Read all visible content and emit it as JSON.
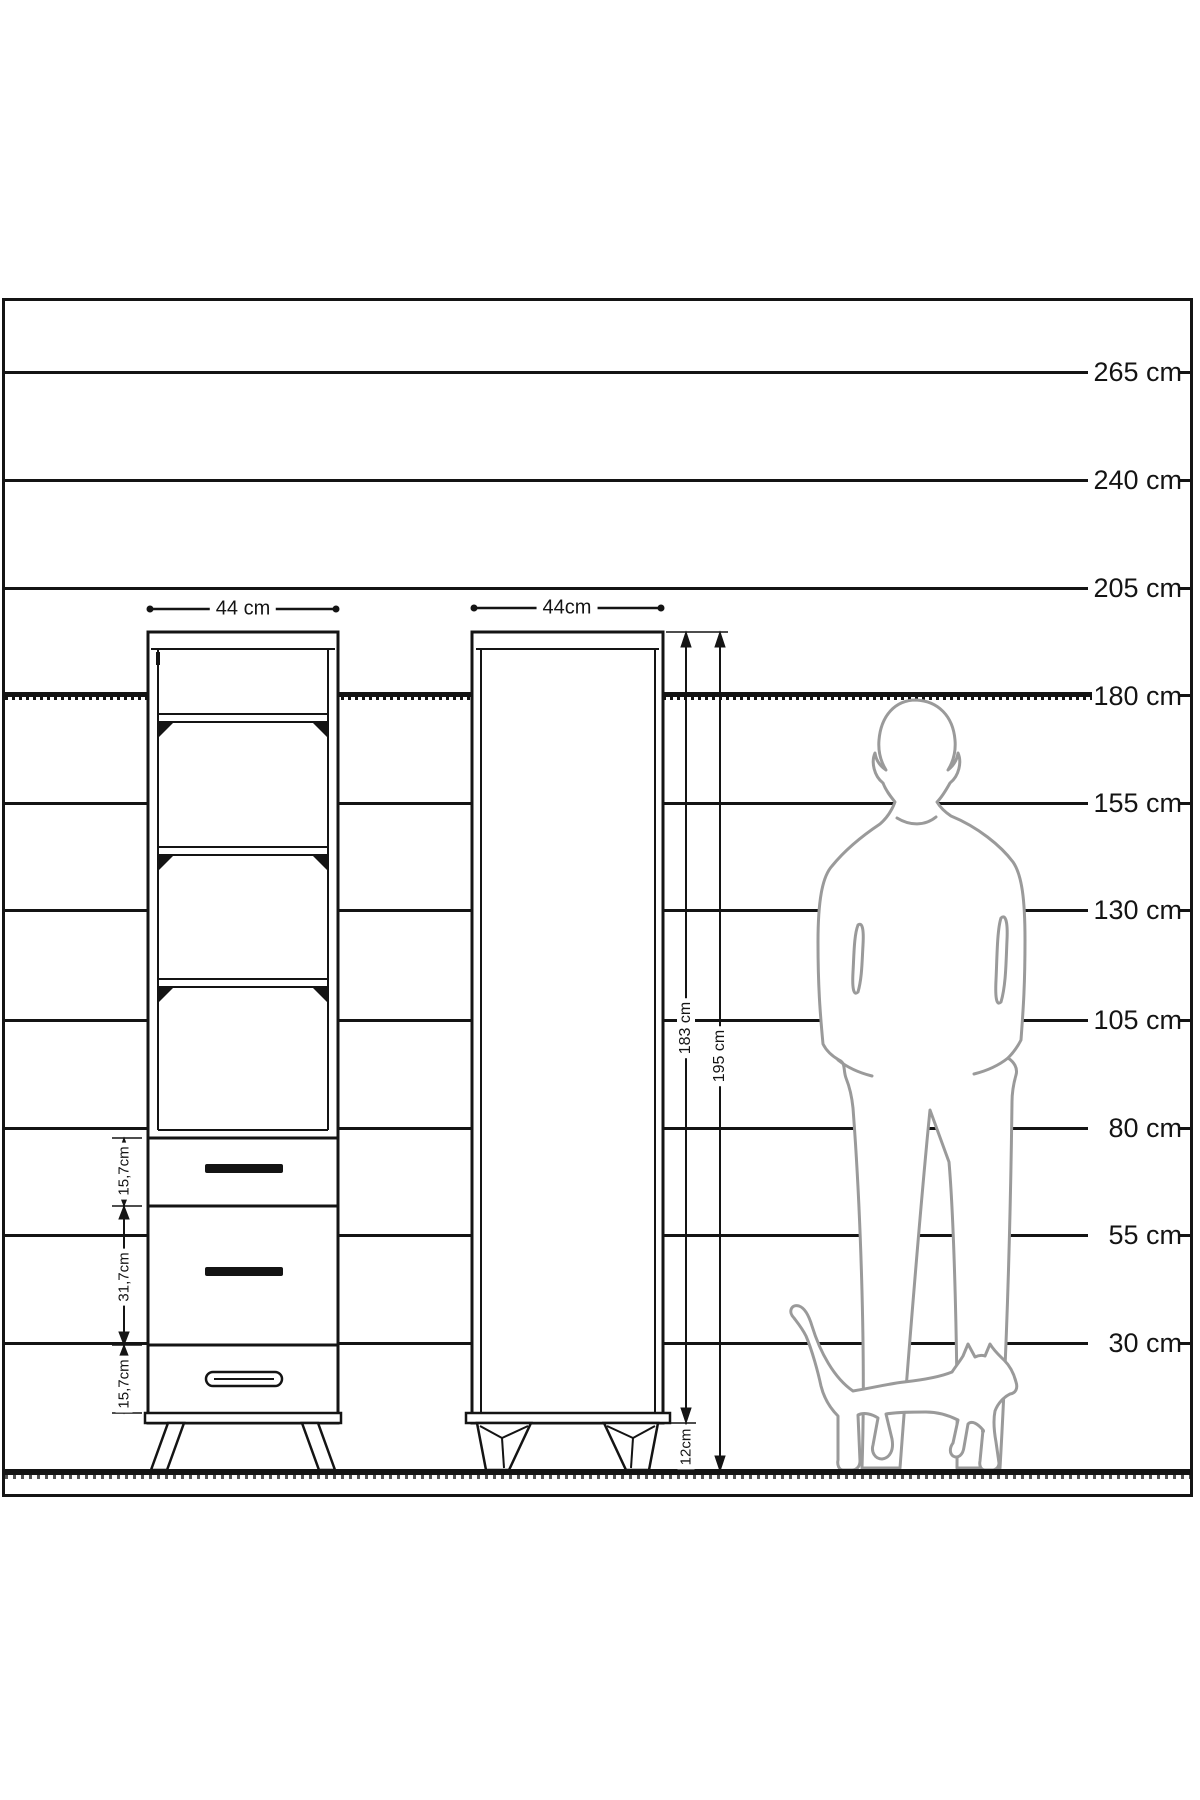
{
  "diagram": {
    "title": "furniture-height-scale-diagram",
    "unit": "cm",
    "ink_color": "#141414",
    "silhouette_color": "#9a9a9a",
    "scale_labels": [
      "265 cm",
      "240 cm",
      "205 cm",
      "180 cm",
      "155 cm",
      "130 cm",
      "105 cm",
      "80 cm",
      "55 cm",
      "30 cm"
    ]
  },
  "left_cabinet": {
    "type": "open-shelf-unit-with-drawers",
    "width_label": "44 cm",
    "drawer_height_labels": [
      "15,7cm",
      "31,7cm",
      "15,7cm"
    ]
  },
  "right_cabinet": {
    "type": "single-door-wardrobe",
    "width_label": "44cm",
    "body_height_label": "183 cm",
    "total_height_label": "195 cm",
    "leg_height_label": "12cm"
  }
}
